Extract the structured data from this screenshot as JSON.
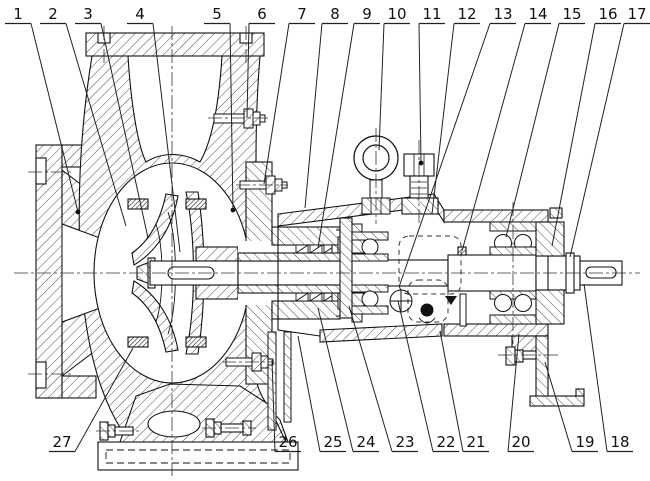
{
  "figure": {
    "kind": "technical-sectional-drawing",
    "subject": "end-suction centrifugal pump cross-section",
    "background": "#ffffff",
    "ink": "#1a1a1a"
  },
  "callouts": {
    "top": [
      {
        "label": "1",
        "x": 18,
        "tx": 78,
        "ty": 212,
        "dot": true
      },
      {
        "label": "2",
        "x": 53,
        "tx": 126,
        "ty": 226
      },
      {
        "label": "3",
        "x": 88,
        "tx": 148,
        "ty": 238
      },
      {
        "label": "4",
        "x": 140,
        "tx": 180,
        "ty": 252
      },
      {
        "label": "5",
        "x": 217,
        "tx": 233,
        "ty": 210,
        "dot": true
      },
      {
        "label": "6",
        "x": 262,
        "tx": 247,
        "ty": 118
      },
      {
        "label": "7",
        "x": 302,
        "tx": 264,
        "ty": 184
      },
      {
        "label": "8",
        "x": 335,
        "tx": 305,
        "ty": 208
      },
      {
        "label": "9",
        "x": 367,
        "tx": 318,
        "ty": 248
      },
      {
        "label": "10",
        "x": 397,
        "tx": 379,
        "ty": 150
      },
      {
        "label": "11",
        "x": 432,
        "tx": 421,
        "ty": 163,
        "dot": true
      },
      {
        "label": "12",
        "x": 467,
        "tx": 432,
        "ty": 214
      },
      {
        "label": "13",
        "x": 503,
        "tx": 399,
        "ty": 287
      },
      {
        "label": "14",
        "x": 538,
        "tx": 462,
        "ty": 251
      },
      {
        "label": "15",
        "x": 572,
        "tx": 506,
        "ty": 237
      },
      {
        "label": "16",
        "x": 608,
        "tx": 552,
        "ty": 246
      },
      {
        "label": "17",
        "x": 637,
        "tx": 570,
        "ty": 257
      }
    ],
    "bottom": [
      {
        "label": "27",
        "x": 62,
        "tx": 133,
        "ty": 348
      },
      {
        "label": "26",
        "x": 288,
        "tx": 272,
        "ty": 360
      },
      {
        "label": "25",
        "x": 333,
        "tx": 298,
        "ty": 336
      },
      {
        "label": "24",
        "x": 366,
        "tx": 318,
        "ty": 308
      },
      {
        "label": "23",
        "x": 405,
        "tx": 349,
        "ty": 306
      },
      {
        "label": "22",
        "x": 446,
        "tx": 398,
        "ty": 301
      },
      {
        "label": "21",
        "x": 476,
        "tx": 440,
        "ty": 331
      },
      {
        "label": "20",
        "x": 521,
        "tx": 519,
        "ty": 334
      },
      {
        "label": "19",
        "x": 585,
        "tx": 545,
        "ty": 362
      },
      {
        "label": "18",
        "x": 620,
        "tx": 584,
        "ty": 284
      }
    ]
  }
}
